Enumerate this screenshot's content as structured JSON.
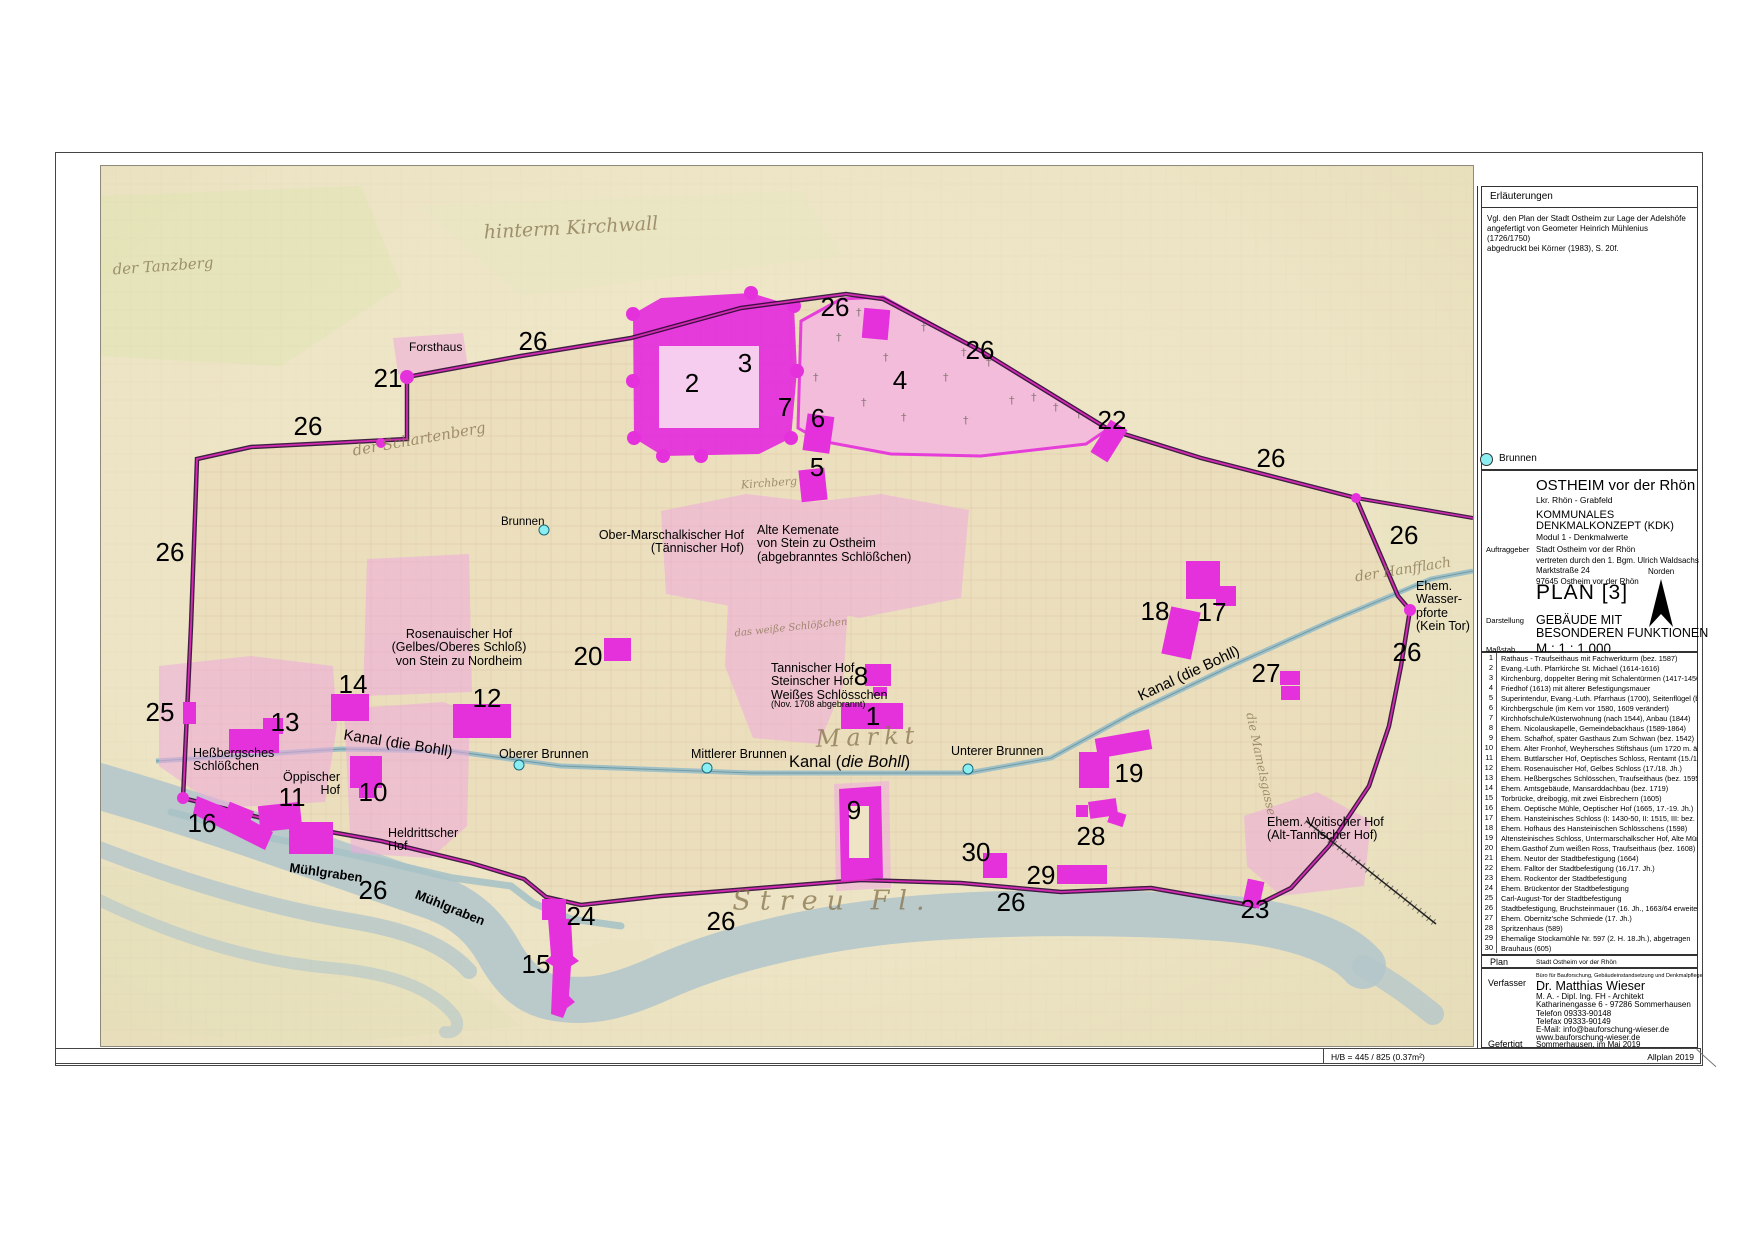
{
  "sheet": {
    "bottom_bar": {
      "hb": "H/B = 445 / 825 (0.37m²)",
      "software": "Allplan 2019"
    }
  },
  "erlaeuterungen": {
    "title": "Erläuterungen",
    "body": [
      "Vgl. den Plan der Stadt Ostheim zur Lage der Adelshöfe",
      "angefertigt von Geometer Heinrich Mühlenius (1726/1750)",
      "abgedruckt bei Körner (1983), S. 20f."
    ],
    "brunnen_label": "Brunnen"
  },
  "titleblock": {
    "city": "OSTHEIM vor der Rhön",
    "district": "Lkr. Rhön - Grabfeld",
    "project1": "KOMMUNALES",
    "project2": "DENKMALKONZEPT (KDK)",
    "module": "Modul 1 - Denkmalwerte",
    "auftraggeber_label": "Auftraggeber",
    "auftraggeber": [
      "Stadt Ostheim vor der Rhön",
      "vertreten durch den 1. Bgm. Ulrich Waldsachs",
      "Marktstraße 24",
      "97645 Ostheim vor der Rhön"
    ],
    "norden": "Norden",
    "plan_no": "PLAN [3]",
    "darstellung_label": "Darstellung",
    "darstellung1": "GEBÄUDE MIT",
    "darstellung2": "BESONDEREN FUNKTIONEN",
    "massstab_label": "Maßstab",
    "massstab": "M.:  1 : 1.000"
  },
  "legend": {
    "items": [
      {
        "no": "1",
        "text": "Rathaus - Traufseithaus mit Fachwerkturm (bez. 1587)"
      },
      {
        "no": "2",
        "text": "Evang.-Luth. Pfarrkirche St. Michael (1614-1616)"
      },
      {
        "no": "3",
        "text": "Kirchenburg, doppelter Bering mit Schalentürmen (1417-1450)"
      },
      {
        "no": "4",
        "text": "Friedhof (1613) mit älterer Befestigungsmauer"
      },
      {
        "no": "5",
        "text": "Superintendur, Evang.-Luth. Pfarrhaus (1700), Seitenflügel (bez. 1753)"
      },
      {
        "no": "6",
        "text": "Kirchbergschule (im Kern vor 1580, 1609 verändert)"
      },
      {
        "no": "7",
        "text": "Kirchhofschule/Küsterwohnung (nach 1544), Anbau (1844)"
      },
      {
        "no": "8",
        "text": "Ehem. Nicolauskapelle, Gemeindebackhaus (1589-1864)"
      },
      {
        "no": "9",
        "text": "Ehem. Schafhof, später Gasthaus Zum Schwan (bez. 1542)"
      },
      {
        "no": "10",
        "text": "Ehem. Alter Fronhof, Weyhersches Stiftshaus (um 1720 m. ält. Kern)"
      },
      {
        "no": "11",
        "text": "Ehem. Buttlarscher Hof, Oeptisches Schloss, Rentamt (15./16. Jh.)"
      },
      {
        "no": "12",
        "text": "Ehem. Rosenauischer Hof, Gelbes Schloss (17./18. Jh.)"
      },
      {
        "no": "13",
        "text": "Ehem. Heßbergsches Schlösschen, Traufseithaus (bez. 1595)"
      },
      {
        "no": "14",
        "text": "Ehem. Amtsgebäude, Mansarddachbau (bez. 1719)"
      },
      {
        "no": "15",
        "text": "Torbrücke, dreibogig, mit zwei Eisbrechern (1605)"
      },
      {
        "no": "16",
        "text": "Ehem. Oeptische Mühle, Oeptischer Hof (1665, 17.-19. Jh.)"
      },
      {
        "no": "17",
        "text": "Ehem. Hansteinisches Schloss (I: 1430-50, II: 1515, III: bez. 1599 u. 1604)"
      },
      {
        "no": "18",
        "text": "Ehem. Hofhaus des Hansteinischen Schlösschens (1598)"
      },
      {
        "no": "19",
        "text": "Altensteinisches Schloss, Untermarschalkscher Hof, Alte Münze (1753-57)"
      },
      {
        "no": "20",
        "text": "Ehem.Gasthof Zum weißen Ross, Traufseithaus (bez. 1608)"
      },
      {
        "no": "21",
        "text": "Ehem. Neutor der Stadtbefestigung (1664)"
      },
      {
        "no": "22",
        "text": "Ehem. Falltor der Stadtbefestigung (16./17. Jh.)"
      },
      {
        "no": "23",
        "text": "Ehem. Rockentor der Stadtbefestigung"
      },
      {
        "no": "24",
        "text": "Ehem. Brückentor der Stadtbefestigung"
      },
      {
        "no": "25",
        "text": "Carl-August-Tor der Stadtbefestigung"
      },
      {
        "no": "26",
        "text": "Stadtbefestigung, Bruchsteinmauer (16. Jh., 1663/64 erweitert)"
      },
      {
        "no": "27",
        "text": "Ehem. Obernitz'sche Schmiede (17. Jh.)"
      },
      {
        "no": "28",
        "text": "Spritzenhaus (589)"
      },
      {
        "no": "29",
        "text": "Ehemalige Stockamühle Nr. 597 (2. H. 18.Jh.), abgetragen"
      },
      {
        "no": "30",
        "text": "Brauhaus (605)"
      }
    ]
  },
  "plan_row": {
    "label": "Plan",
    "value": "Stadt Ostheim vor der Rhön"
  },
  "verfasser": {
    "label": "Verfasser",
    "buero": "Büro für Bauforschung, Gebäudeinstandsetzung und Denkmalpflege",
    "name": "Dr. Matthias Wieser",
    "lines": [
      "M. A. - Dipl. Ing. FH - Architekt",
      "Katharinengasse 6 - 97286 Sommerhausen",
      "Telefon 09333-90148",
      "Telefax 09333-90149",
      "E-Mail: info@bauforschung-wieser.de",
      "www.bauforschung-wieser.de"
    ],
    "gefertigt_label": "Gefertigt",
    "gefertigt": "Sommerhausen, im Mai 2019"
  },
  "map": {
    "numbers": [
      {
        "n": "21",
        "x": 287,
        "y": 212
      },
      {
        "n": "26",
        "x": 432,
        "y": 175
      },
      {
        "n": "26",
        "x": 207,
        "y": 260
      },
      {
        "n": "26",
        "x": 69,
        "y": 386
      },
      {
        "n": "25",
        "x": 59,
        "y": 546
      },
      {
        "n": "13",
        "x": 184,
        "y": 556
      },
      {
        "n": "14",
        "x": 252,
        "y": 518
      },
      {
        "n": "12",
        "x": 386,
        "y": 532
      },
      {
        "n": "20",
        "x": 487,
        "y": 490
      },
      {
        "n": "16",
        "x": 101,
        "y": 657
      },
      {
        "n": "11",
        "x": 191,
        "y": 631
      },
      {
        "n": "10",
        "x": 272,
        "y": 626
      },
      {
        "n": "2",
        "x": 591,
        "y": 217
      },
      {
        "n": "3",
        "x": 644,
        "y": 197
      },
      {
        "n": "7",
        "x": 684,
        "y": 241
      },
      {
        "n": "6",
        "x": 717,
        "y": 252
      },
      {
        "n": "5",
        "x": 716,
        "y": 301
      },
      {
        "n": "26",
        "x": 734,
        "y": 141
      },
      {
        "n": "4",
        "x": 799,
        "y": 214
      },
      {
        "n": "26",
        "x": 879,
        "y": 184
      },
      {
        "n": "22",
        "x": 1011,
        "y": 254
      },
      {
        "n": "26",
        "x": 1170,
        "y": 292
      },
      {
        "n": "26",
        "x": 1303,
        "y": 369
      },
      {
        "n": "26",
        "x": 1306,
        "y": 486
      },
      {
        "n": "27",
        "x": 1165,
        "y": 507
      },
      {
        "n": "18",
        "x": 1054,
        "y": 445
      },
      {
        "n": "17",
        "x": 1111,
        "y": 446
      },
      {
        "n": "8",
        "x": 760,
        "y": 510
      },
      {
        "n": "1",
        "x": 772,
        "y": 550
      },
      {
        "n": "19",
        "x": 1028,
        "y": 607
      },
      {
        "n": "28",
        "x": 990,
        "y": 670
      },
      {
        "n": "30",
        "x": 875,
        "y": 686
      },
      {
        "n": "29",
        "x": 940,
        "y": 709
      },
      {
        "n": "9",
        "x": 753,
        "y": 644
      },
      {
        "n": "24",
        "x": 480,
        "y": 750
      },
      {
        "n": "15",
        "x": 435,
        "y": 798
      },
      {
        "n": "26",
        "x": 620,
        "y": 755
      },
      {
        "n": "26",
        "x": 272,
        "y": 724
      },
      {
        "n": "26",
        "x": 910,
        "y": 736
      },
      {
        "n": "23",
        "x": 1154,
        "y": 743
      }
    ],
    "labels": [
      {
        "lines": [
          "Forsthaus"
        ],
        "x": 308,
        "y": 175,
        "align": "left",
        "size": 12
      },
      {
        "lines": [
          "Brunnen"
        ],
        "x": 400,
        "y": 350,
        "align": "left",
        "size": 11.5
      },
      {
        "lines": [
          "Ober-Marschalkischer Hof",
          "(Tännischer Hof)"
        ],
        "x": 643,
        "y": 363,
        "align": "right",
        "size": 12.5
      },
      {
        "lines": [
          "Alte Kemenate",
          "von Stein zu Ostheim",
          "(abgebranntes Schlößchen)"
        ],
        "x": 656,
        "y": 358,
        "align": "left",
        "size": 12.5
      },
      {
        "lines": [
          "Rosenauischer Hof",
          "(Gelbes/Oberes Schloß)",
          "von Stein zu Nordheim"
        ],
        "x": 358,
        "y": 462,
        "align": "center",
        "size": 12.5
      },
      {
        "lines": [
          "Heßbergsches",
          "Schlößchen"
        ],
        "x": 92,
        "y": 581,
        "align": "left",
        "size": 12.5
      },
      {
        "lines": [
          "Öppischer",
          "Hof"
        ],
        "x": 239,
        "y": 605,
        "align": "right",
        "size": 12.5
      },
      {
        "lines": [
          "Heldrittscher",
          "Hof"
        ],
        "x": 287,
        "y": 661,
        "align": "left",
        "size": 12.5
      },
      {
        "lines": [
          "Tannischer Hof",
          "Steinscher Hof",
          "Weißes Schlösschen"
        ],
        "x": 670,
        "y": 496,
        "align": "left",
        "size": 12.5
      },
      {
        "lines": [
          "(Nov. 1708 abgebrannt)"
        ],
        "x": 670,
        "y": 534,
        "align": "left",
        "size": 9
      },
      {
        "lines": [
          "Oberer Brunnen"
        ],
        "x": 398,
        "y": 582,
        "align": "left",
        "size": 12.5
      },
      {
        "lines": [
          "Mittlerer Brunnen"
        ],
        "x": 590,
        "y": 582,
        "align": "left",
        "size": 12.5
      },
      {
        "lines": [
          "Unterer Brunnen"
        ],
        "x": 850,
        "y": 579,
        "align": "left",
        "size": 12.5
      },
      {
        "lines": [
          "Kanal (die Bohll)"
        ],
        "x": 297,
        "y": 570,
        "align": "center",
        "size": 15,
        "rot": 9
      },
      {
        "pre": "Kanal (",
        "it": "die Bohll",
        "post": ")",
        "lines": [
          "Kanal (die Bohll)"
        ],
        "x": 688,
        "y": 588,
        "align": "left",
        "size": 16.5
      },
      {
        "lines": [
          "Kanal (die Bohll)"
        ],
        "x": 1088,
        "y": 500,
        "align": "center",
        "size": 15,
        "rot": -25
      },
      {
        "lines": [
          "Ehem. Voitischer Hof",
          "(Alt-Tannischer Hof)"
        ],
        "x": 1166,
        "y": 650,
        "align": "left",
        "size": 12.5
      },
      {
        "lines": [
          "Ehem.",
          "Wasser-",
          "pforte",
          "(Kein Tor)"
        ],
        "x": 1315,
        "y": 414,
        "align": "left",
        "size": 12.5
      },
      {
        "lines": [
          "Mühlgraben"
        ],
        "x": 225,
        "y": 700,
        "align": "center",
        "size": 13,
        "rot": 8,
        "bold": true
      },
      {
        "lines": [
          "Mühlgraben"
        ],
        "x": 349,
        "y": 735,
        "align": "center",
        "size": 13,
        "rot": 22,
        "bold": true
      }
    ],
    "old_labels": [
      {
        "t": "hinterm Kirchwall",
        "x": 470,
        "y": 62,
        "size": 19,
        "rot": -3
      },
      {
        "t": "der Tanzberg",
        "x": 62,
        "y": 100,
        "size": 15,
        "rot": -4
      },
      {
        "t": "der Schartenberg",
        "x": 318,
        "y": 273,
        "size": 15,
        "rot": -10
      },
      {
        "t": "Kirchberg",
        "x": 668,
        "y": 317,
        "size": 11,
        "rot": -4
      },
      {
        "t": "das weiße Schlößchen",
        "x": 690,
        "y": 462,
        "size": 10,
        "rot": -6
      },
      {
        "t": "Markt",
        "x": 767,
        "y": 571,
        "size": 24,
        "rot": -2,
        "ls": 6
      },
      {
        "t": "Streu Fl.",
        "x": 732,
        "y": 735,
        "size": 27,
        "rot": 0,
        "ls": 9
      },
      {
        "t": "der Hanfflach",
        "x": 1302,
        "y": 404,
        "size": 14,
        "rot": -9
      },
      {
        "t": "die Mamelsgasse",
        "x": 1160,
        "y": 598,
        "size": 12,
        "rot": 78
      }
    ],
    "wells": [
      {
        "x": 443,
        "y": 364
      },
      {
        "x": 418,
        "y": 599
      },
      {
        "x": 606,
        "y": 602
      },
      {
        "x": 867,
        "y": 603
      }
    ],
    "icons": {
      "cemetery_cross": "†",
      "north_arrow": "▲"
    }
  },
  "colors": {
    "magenta": "#e531dc",
    "pink_area": "#efa9dc",
    "cemetery": "#f4bade",
    "water": "#b5c7cb",
    "canal": "#9fc0c6",
    "wall_outer": "#2b0a33",
    "wall_core": "#d42bb4",
    "well": "#8beef2",
    "parchment": "#ece4c4",
    "town": "#e7d7b4",
    "old_script": "#86744e"
  }
}
